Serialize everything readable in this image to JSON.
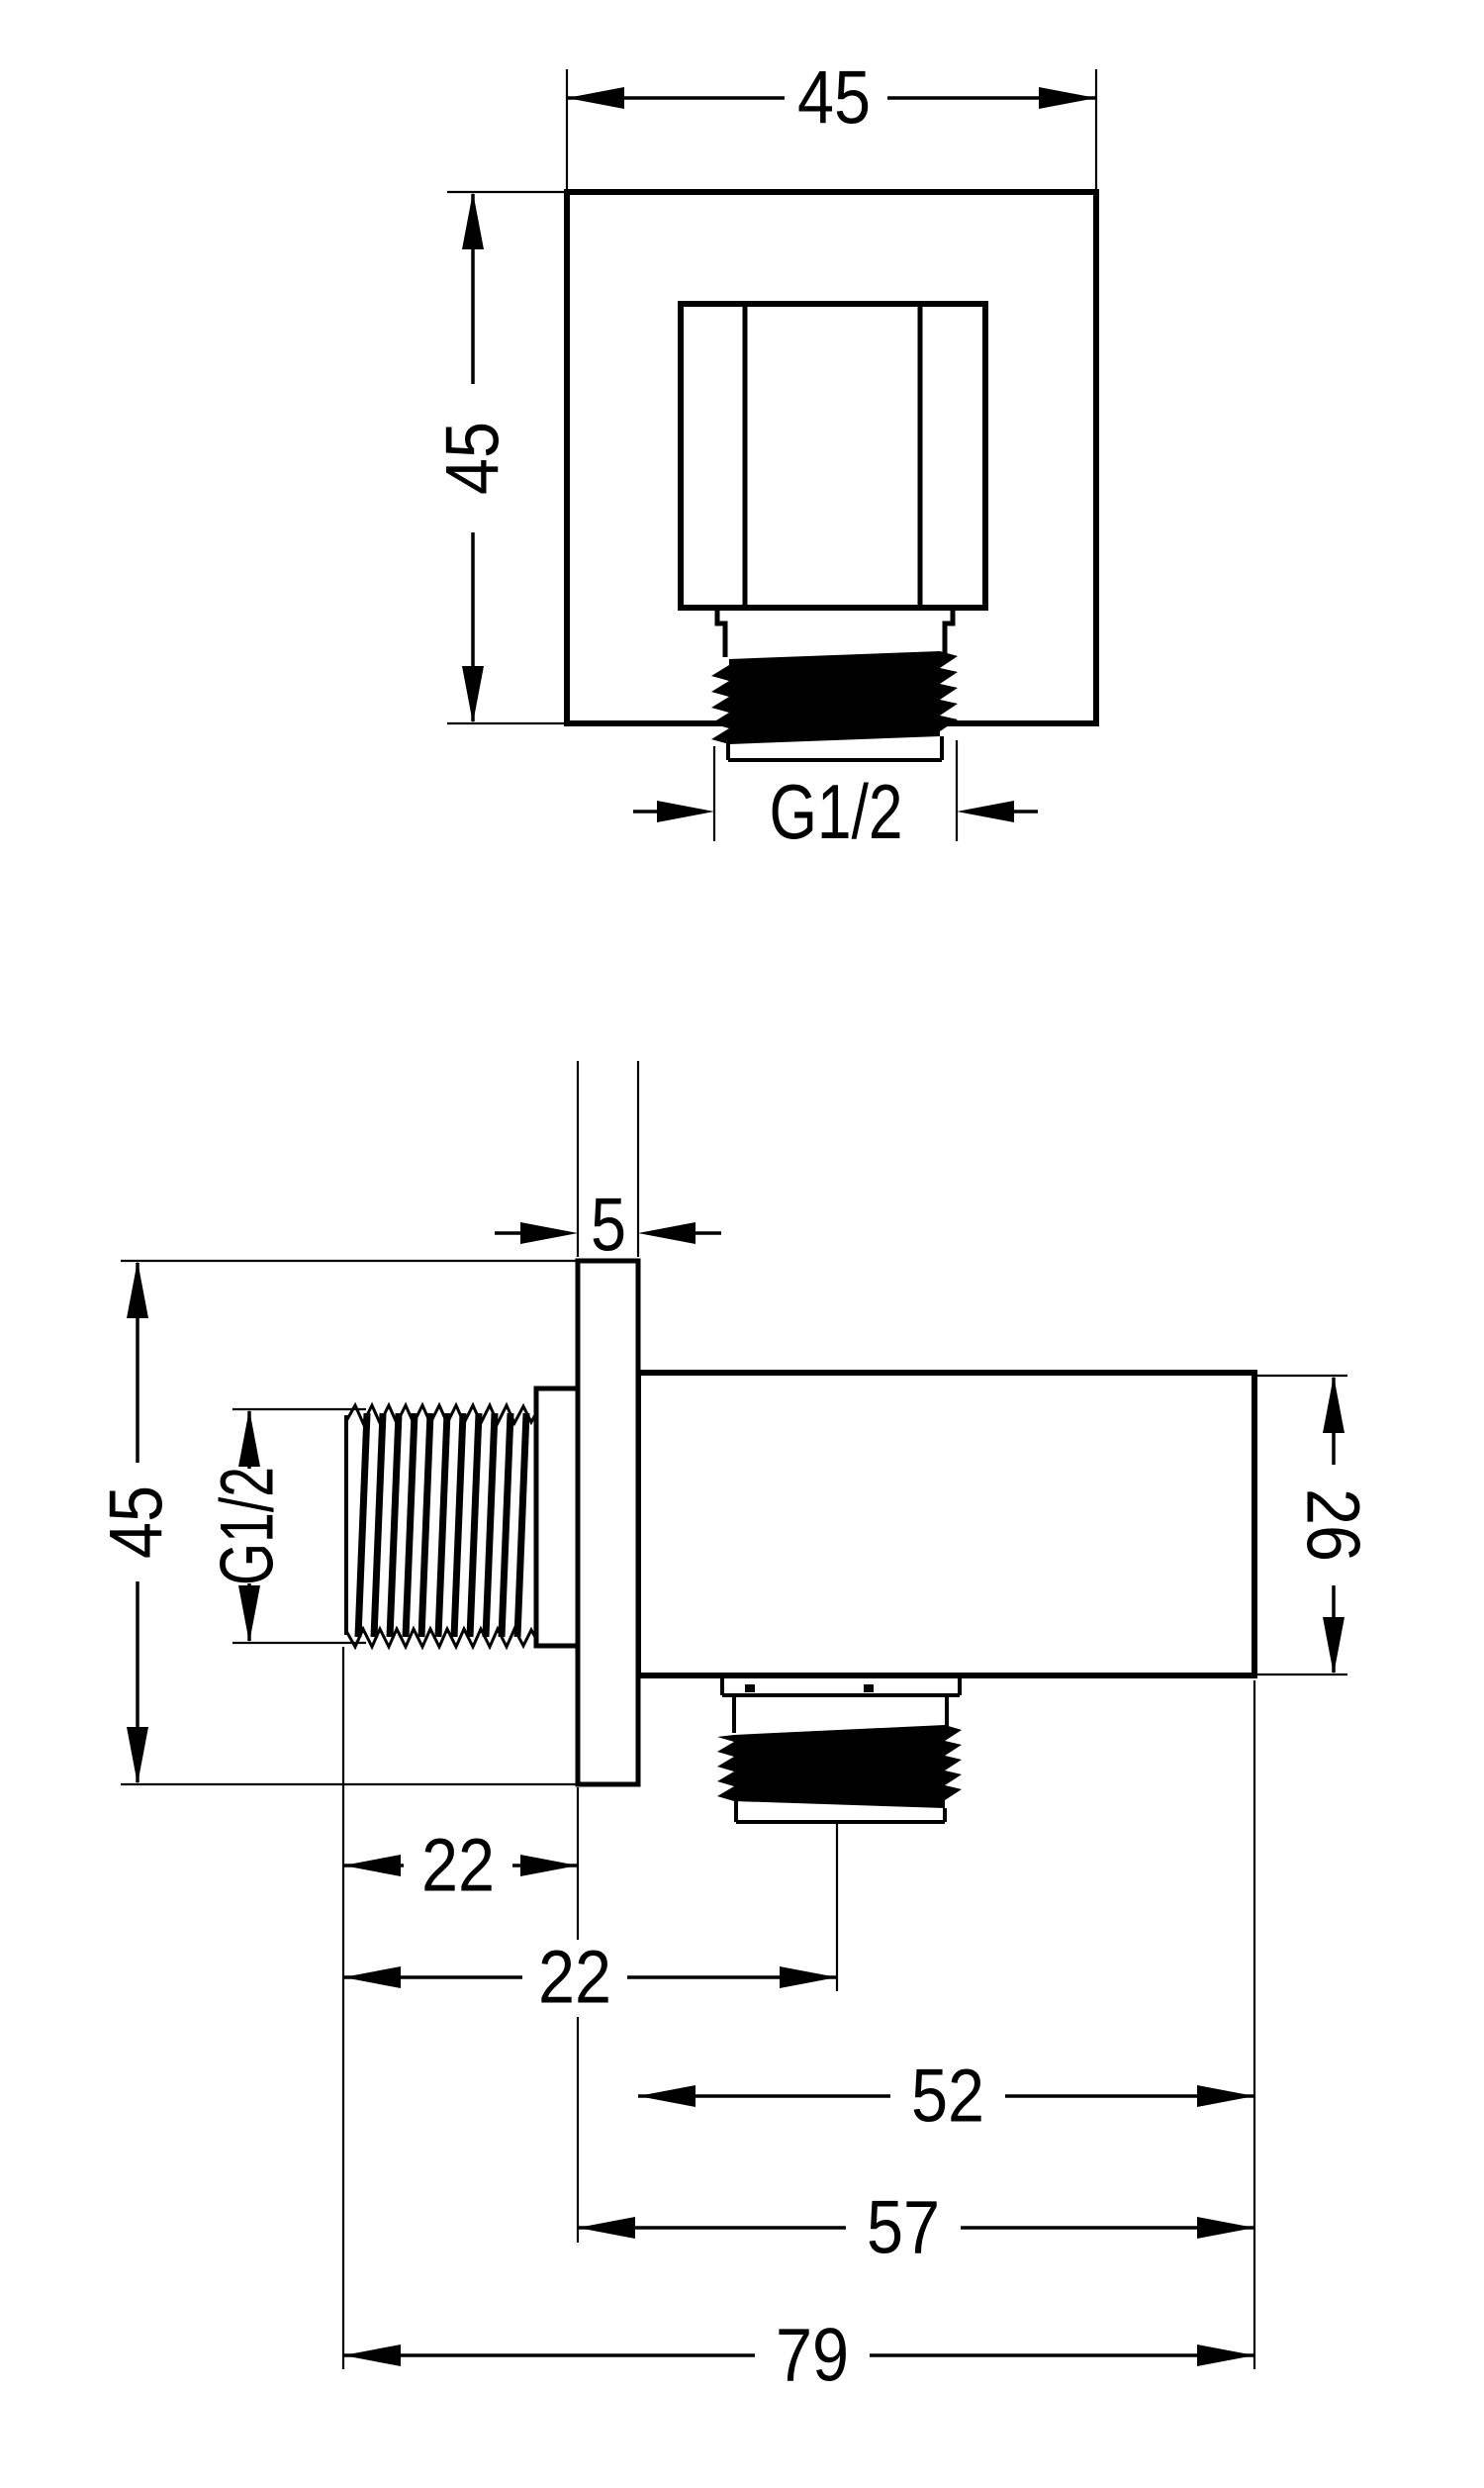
{
  "page": {
    "background": "#ffffff",
    "line_color": "#000000"
  },
  "front_view": {
    "dims": {
      "width": "45",
      "height": "45",
      "thread": "G1/2"
    }
  },
  "side_view": {
    "dims": {
      "plate_thickness": "5",
      "height": "45",
      "thread": "G1/2",
      "body_height": "26",
      "thread_length": "22",
      "outlet_offset": "22",
      "body_depth": "52",
      "depth_with_plate": "57",
      "total_depth": "79"
    }
  }
}
